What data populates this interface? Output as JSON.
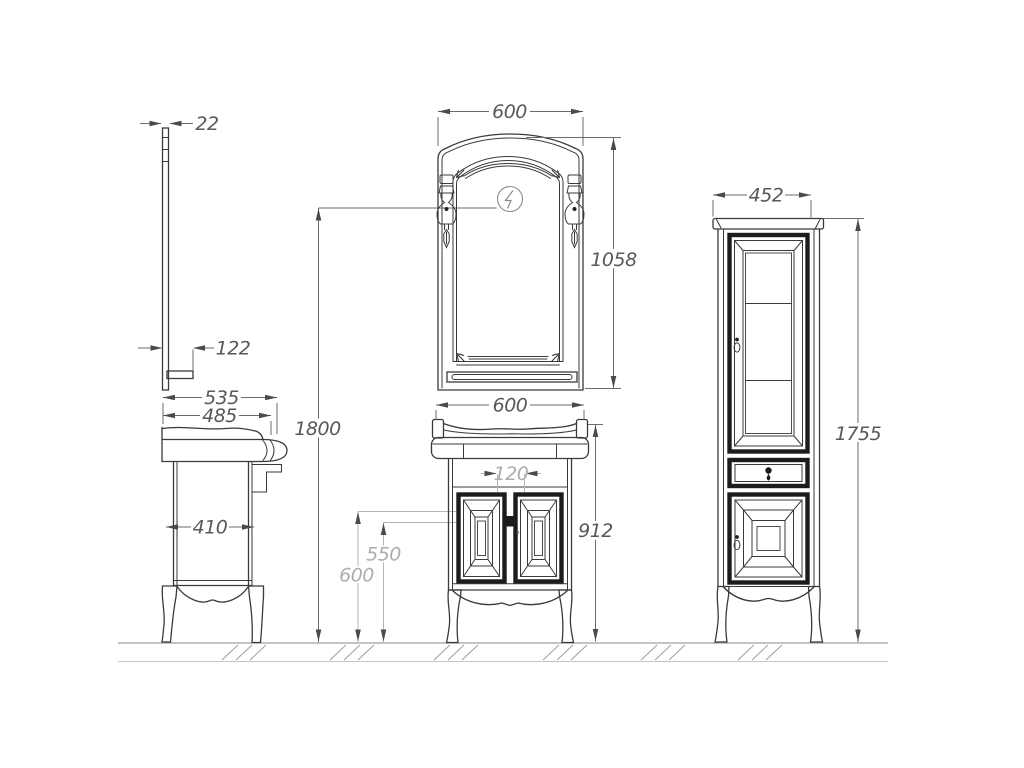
{
  "drawing": {
    "title": "Bathroom furniture set — dimensioned technical drawing",
    "type": "orthographic projection",
    "units": "mm",
    "views": [
      "mirror side profile",
      "vanity side view",
      "mirror front view",
      "vanity front view",
      "tall cabinet front view"
    ],
    "colors": {
      "line": "#3a3a3a",
      "dark_frame": "#1c1c1c",
      "dim_line": "#6b6b6b",
      "dim_text": "#585858",
      "light_dim_line": "#b5b5b5",
      "light_dim_text": "#adadad",
      "ground": "#9aa0a0",
      "background": "#ffffff"
    }
  },
  "dims": {
    "mirror_thickness": "22",
    "mirror_shelf_depth": "122",
    "vanity_depth_total": "535",
    "vanity_counter_depth": "485",
    "vanity_body_depth": "410",
    "light_center_height": "1800",
    "mirror_width": "600",
    "mirror_height": "1058",
    "vanity_width": "600",
    "door_handle_gap": "120",
    "height_550": "550",
    "height_600": "600",
    "vanity_height": "912",
    "cabinet_width": "452",
    "cabinet_height": "1755"
  }
}
